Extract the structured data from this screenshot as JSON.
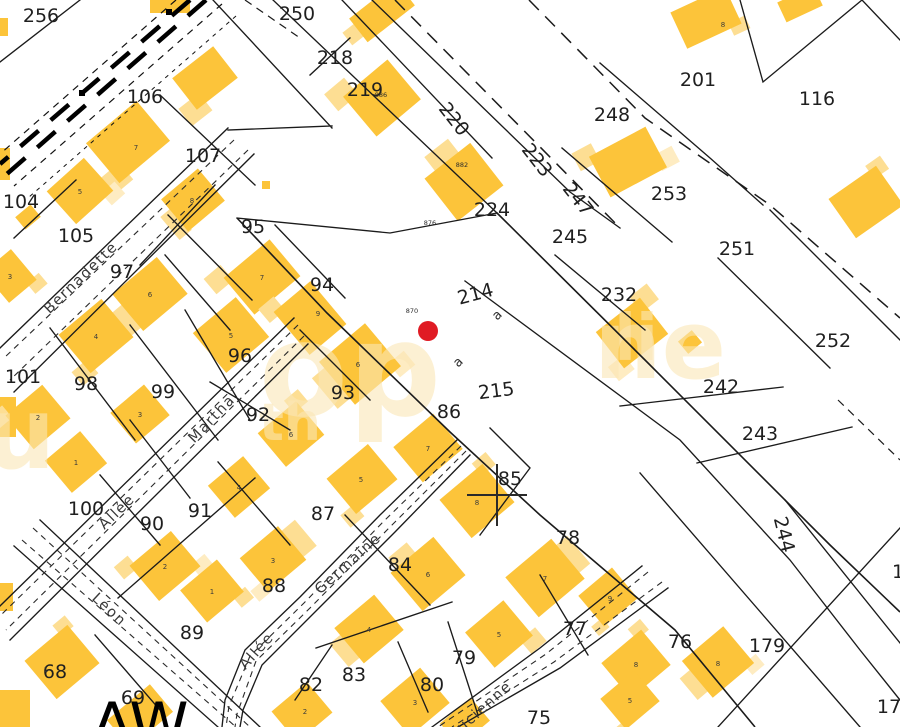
{
  "map": {
    "colors": {
      "background": "#ffffff",
      "building_main": "#FCC43A",
      "building_annex": "#FDDE93",
      "building_annex_lighter": "#FEECC2",
      "boundary_line": "#1b1b1b",
      "parcel_label_text": "#1f1f1f",
      "marker_red": "#E01B24",
      "watermark": "#FBE7B6"
    },
    "marker": {
      "x": 428,
      "y": 331,
      "r": 10,
      "color": "#E01B24"
    },
    "section_label": {
      "text": "AW",
      "x": 140,
      "y": 745
    },
    "parcel_labels": [
      {
        "t": "256",
        "x": 41,
        "y": 22
      },
      {
        "t": "250",
        "x": 297,
        "y": 20
      },
      {
        "t": "218",
        "x": 335,
        "y": 64
      },
      {
        "t": "219",
        "x": 365,
        "y": 96
      },
      {
        "t": "106",
        "x": 145,
        "y": 103
      },
      {
        "t": "107",
        "x": 203,
        "y": 162
      },
      {
        "t": "104",
        "x": 21,
        "y": 208
      },
      {
        "t": "105",
        "x": 76,
        "y": 242
      },
      {
        "t": "95",
        "x": 253,
        "y": 233
      },
      {
        "t": "97",
        "x": 122,
        "y": 278
      },
      {
        "t": "224",
        "x": 492,
        "y": 216
      },
      {
        "t": "245",
        "x": 570,
        "y": 243
      },
      {
        "t": "248",
        "x": 612,
        "y": 121
      },
      {
        "t": "201",
        "x": 698,
        "y": 86
      },
      {
        "t": "116",
        "x": 817,
        "y": 105
      },
      {
        "t": "253",
        "x": 669,
        "y": 200
      },
      {
        "t": "251",
        "x": 737,
        "y": 255
      },
      {
        "t": "252",
        "x": 833,
        "y": 347
      },
      {
        "t": "232",
        "x": 619,
        "y": 301
      },
      {
        "t": "242",
        "x": 721,
        "y": 393
      },
      {
        "t": "243",
        "x": 760,
        "y": 440
      },
      {
        "t": "94",
        "x": 322,
        "y": 291
      },
      {
        "t": "96",
        "x": 240,
        "y": 362
      },
      {
        "t": "101",
        "x": 23,
        "y": 383
      },
      {
        "t": "98",
        "x": 86,
        "y": 390
      },
      {
        "t": "99",
        "x": 163,
        "y": 398
      },
      {
        "t": "92",
        "x": 258,
        "y": 421
      },
      {
        "t": "93",
        "x": 343,
        "y": 399
      },
      {
        "t": "86",
        "x": 449,
        "y": 418
      },
      {
        "t": "85",
        "x": 510,
        "y": 485
      },
      {
        "t": "87",
        "x": 323,
        "y": 520
      },
      {
        "t": "84",
        "x": 400,
        "y": 571
      },
      {
        "t": "100",
        "x": 86,
        "y": 515
      },
      {
        "t": "90",
        "x": 152,
        "y": 530
      },
      {
        "t": "91",
        "x": 200,
        "y": 517
      },
      {
        "t": "88",
        "x": 274,
        "y": 592
      },
      {
        "t": "89",
        "x": 192,
        "y": 639
      },
      {
        "t": "68",
        "x": 55,
        "y": 678
      },
      {
        "t": "69",
        "x": 133,
        "y": 704
      },
      {
        "t": "82",
        "x": 311,
        "y": 691
      },
      {
        "t": "83",
        "x": 354,
        "y": 681
      },
      {
        "t": "80",
        "x": 432,
        "y": 691
      },
      {
        "t": "79",
        "x": 464,
        "y": 664
      },
      {
        "t": "78",
        "x": 568,
        "y": 544
      },
      {
        "t": "77",
        "x": 575,
        "y": 635
      },
      {
        "t": "75",
        "x": 539,
        "y": 724
      },
      {
        "t": "76",
        "x": 680,
        "y": 648
      },
      {
        "t": "179",
        "x": 767,
        "y": 652
      },
      {
        "t": "178",
        "x": 895,
        "y": 713
      },
      {
        "t": "1",
        "x": 898,
        "y": 578
      },
      {
        "t": "214",
        "x": 477,
        "y": 300,
        "r": -15
      },
      {
        "t": "215",
        "x": 497,
        "y": 397,
        "r": -7
      },
      {
        "t": "220",
        "x": 449,
        "y": 123,
        "r": 52
      },
      {
        "t": "223",
        "x": 532,
        "y": 164,
        "r": 52
      },
      {
        "t": "247",
        "x": 573,
        "y": 203,
        "r": 52
      },
      {
        "t": "244",
        "x": 778,
        "y": 536,
        "r": 76
      }
    ],
    "road_sublabels": [
      {
        "t": "a",
        "x": 500,
        "y": 318,
        "r": -45,
        "fs": 13
      },
      {
        "t": "a",
        "x": 461,
        "y": 365,
        "r": -45,
        "fs": 13
      },
      {
        "t": "870",
        "x": 412,
        "y": 313,
        "fs": 6.5
      },
      {
        "t": "876",
        "x": 430,
        "y": 225,
        "fs": 6.5
      },
      {
        "t": "886",
        "x": 381,
        "y": 97,
        "fs": 6.5
      },
      {
        "t": "882",
        "x": 462,
        "y": 167,
        "fs": 6.5
      }
    ],
    "building_numbers": [
      {
        "t": "7",
        "x": 136,
        "y": 150
      },
      {
        "t": "5",
        "x": 80,
        "y": 194
      },
      {
        "t": "8",
        "x": 192,
        "y": 203
      },
      {
        "t": "8",
        "x": 723,
        "y": 27
      },
      {
        "t": "3",
        "x": 10,
        "y": 279
      },
      {
        "t": "6",
        "x": 150,
        "y": 297
      },
      {
        "t": "7",
        "x": 262,
        "y": 280
      },
      {
        "t": "5",
        "x": 231,
        "y": 338
      },
      {
        "t": "4",
        "x": 96,
        "y": 339
      },
      {
        "t": "9",
        "x": 318,
        "y": 316
      },
      {
        "t": "2",
        "x": 38,
        "y": 420
      },
      {
        "t": "3",
        "x": 140,
        "y": 417
      },
      {
        "t": "6",
        "x": 358,
        "y": 367
      },
      {
        "t": "1",
        "x": 76,
        "y": 465
      },
      {
        "t": "6",
        "x": 291,
        "y": 437
      },
      {
        "t": "4",
        "x": 239,
        "y": 490
      },
      {
        "t": "5",
        "x": 361,
        "y": 482
      },
      {
        "t": "7",
        "x": 428,
        "y": 451
      },
      {
        "t": "8",
        "x": 477,
        "y": 505
      },
      {
        "t": "7",
        "x": 545,
        "y": 581
      },
      {
        "t": "6",
        "x": 428,
        "y": 577
      },
      {
        "t": "2",
        "x": 165,
        "y": 569
      },
      {
        "t": "1",
        "x": 212,
        "y": 594
      },
      {
        "t": "3",
        "x": 273,
        "y": 563
      },
      {
        "t": "4",
        "x": 369,
        "y": 632
      },
      {
        "t": "5",
        "x": 499,
        "y": 637
      },
      {
        "t": "3",
        "x": 415,
        "y": 705
      },
      {
        "t": "2",
        "x": 305,
        "y": 714
      },
      {
        "t": "9",
        "x": 610,
        "y": 601
      },
      {
        "t": "8",
        "x": 636,
        "y": 667
      },
      {
        "t": "8",
        "x": 718,
        "y": 666
      },
      {
        "t": "5",
        "x": 630,
        "y": 703
      },
      {
        "t": "1",
        "x": 46,
        "y": 672
      }
    ],
    "street_names": [
      {
        "t": "Bernadette",
        "x": 84,
        "y": 281,
        "r": -44
      },
      {
        "t": "Martha",
        "x": 215,
        "y": 422,
        "r": -46
      },
      {
        "t": "Allée",
        "x": 120,
        "y": 515,
        "r": -44
      },
      {
        "t": "Léon",
        "x": 106,
        "y": 613,
        "r": 43
      },
      {
        "t": "Germaine",
        "x": 351,
        "y": 567,
        "r": -42
      },
      {
        "t": "Allée",
        "x": 260,
        "y": 654,
        "r": -48
      },
      {
        "t": "Lucienne",
        "x": 484,
        "y": 713,
        "r": -42
      }
    ],
    "watermark_fragments": [
      {
        "t": "op",
        "x": 350,
        "y": 415,
        "fs": 130
      },
      {
        "t": "ne",
        "x": 660,
        "y": 378,
        "fs": 95
      },
      {
        "t": "th",
        "x": 290,
        "y": 440,
        "fs": 52
      },
      {
        "t": "u",
        "x": 20,
        "y": 468,
        "fs": 100
      },
      {
        "t": "li",
        "x": 636,
        "y": 360,
        "fs": 64
      }
    ]
  }
}
